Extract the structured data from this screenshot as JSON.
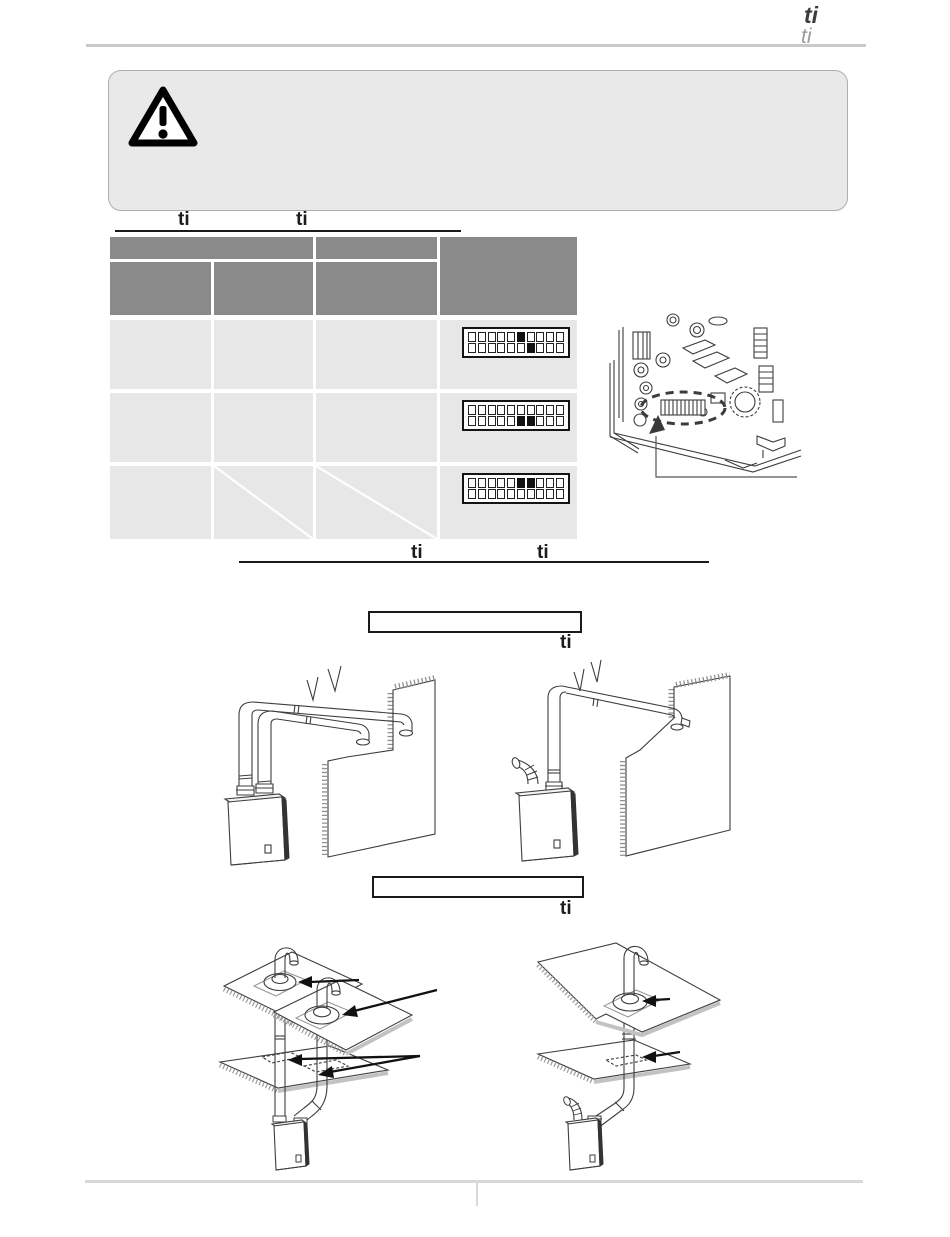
{
  "header": {
    "title_fragment": "ti",
    "subtitle_fragment": "ti"
  },
  "warning": {
    "icon": "warning-triangle-icon",
    "text": ""
  },
  "dip_switch_section": {
    "heading_fragments": [
      "ti",
      "ti"
    ],
    "table": {
      "header_cells_text": [
        "",
        "",
        "",
        "",
        "",
        ""
      ],
      "rows": [
        {
          "dip_states": [
            "none",
            "none",
            "none",
            "none",
            "none",
            "up",
            "down",
            "none",
            "none",
            "none"
          ]
        },
        {
          "dip_states": [
            "none",
            "none",
            "none",
            "none",
            "none",
            "down",
            "down",
            "none",
            "none",
            "none"
          ]
        },
        {
          "dip_states": [
            "none",
            "none",
            "none",
            "none",
            "none",
            "up",
            "up",
            "none",
            "none",
            "none"
          ]
        }
      ],
      "row3_na_cells": 2
    },
    "board_figure": "control-board-with-dip-switch-highlight"
  },
  "vent_section": {
    "heading_fragments": [
      "ti",
      "ti"
    ],
    "figure_sidewall": {
      "label_box_text": "",
      "caption_fragment": "ti"
    },
    "figure_vertical": {
      "label_box_text": "",
      "caption_fragment": "ti"
    }
  }
}
